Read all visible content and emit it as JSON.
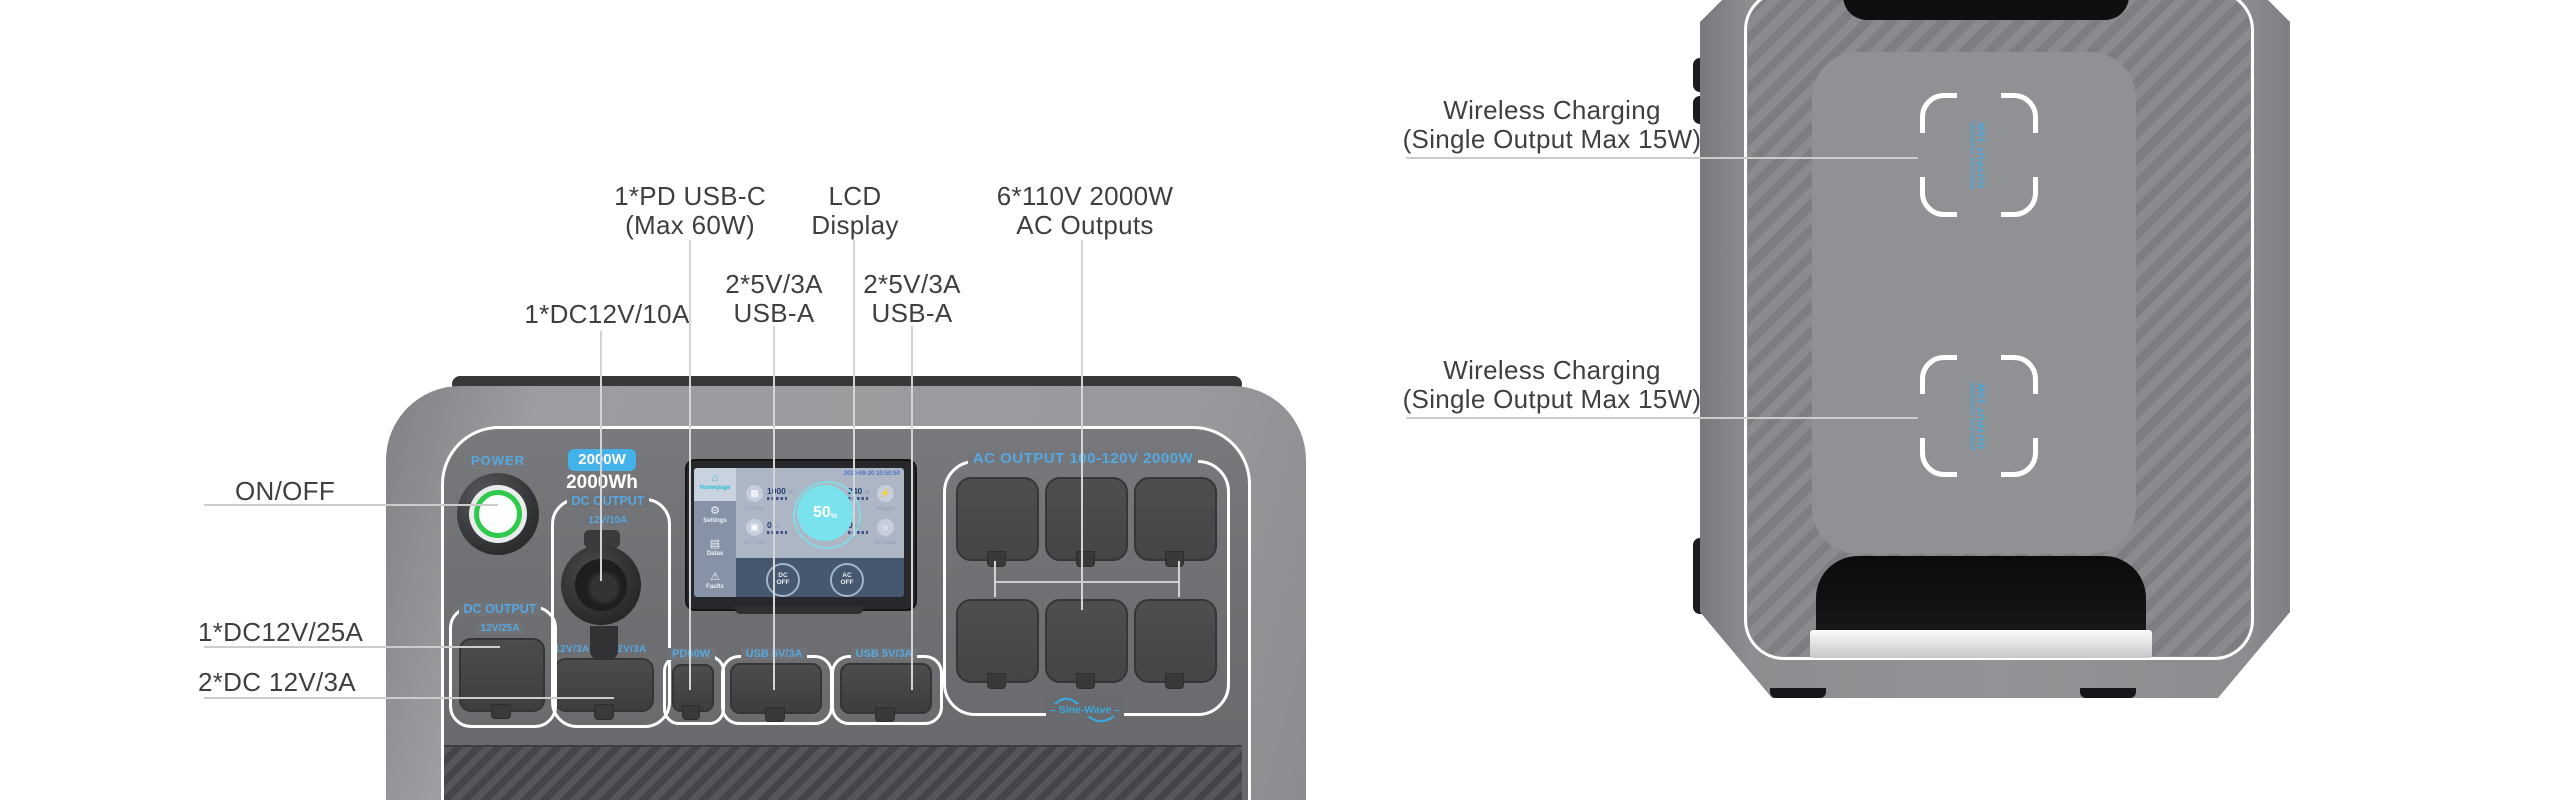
{
  "colors": {
    "accent_blue": "#57a7e0",
    "badge_blue": "#43b2ea",
    "power_green": "#2fc94b",
    "lcd_cyan": "#79e2ec",
    "callout_text": "#3f3f41",
    "callout_line": "#cbccce"
  },
  "front": {
    "callouts": {
      "on_off": "ON/OFF",
      "dc25": "1*DC12V/25A",
      "dc3": "2*DC 12V/3A",
      "dc10": "1*DC12V/10A",
      "pd_line1": "1*PD USB-C",
      "pd_line2": "(Max 60W)",
      "lcd_line1": "LCD",
      "lcd_line2": "Display",
      "usb1_line1": "2*5V/3A",
      "usb1_line2": "USB-A",
      "usb2_line1": "2*5V/3A",
      "usb2_line2": "USB-A",
      "ac_line1": "6*110V 2000W",
      "ac_line2": "AC Outputs"
    },
    "panel": {
      "power_label": "POWER",
      "rated_power": "2000W",
      "capacity": "2000Wh",
      "dc10_title": "DC OUTPUT",
      "dc10_sub": "12V/10A",
      "dc25_title": "DC OUTPUT",
      "dc25_sub": "12V/25A",
      "dc3_left": "12V/3A",
      "dc3_right": "12V/3A",
      "pd_label": "PD60W",
      "usb1_label": "USB 5V/3A",
      "usb2_label": "USB 5V/3A",
      "ac_label": "AC OUTPUT 100-120V 2000W",
      "sine_wave": "Sine-Wave"
    },
    "lcd": {
      "datetime": "2020-09-20 10:50:50",
      "menu": [
        "Homepage",
        "Settings",
        "Datas",
        "Faults"
      ],
      "icons": {
        "home": "⌂",
        "settings": "⚙",
        "datas": "▤",
        "faults": "⚠",
        "pv": "▦",
        "dc": "▣",
        "adapter": "⚡",
        "ac": "☼"
      },
      "stats": {
        "pv_value": "1000",
        "pv_unit": "W",
        "pv_label": "PV/Car",
        "dc_value": "0",
        "dc_unit": "W",
        "dc_label": "DC Load",
        "adapter_value": "240",
        "adapter_unit": "W",
        "adapter_label": "Adapter",
        "ac_value": "0",
        "ac_unit": "W",
        "ac_label": "AC Load"
      },
      "battery_percent": "50",
      "battery_unit": "%",
      "dc_button": "DC OFF",
      "ac_button": "AC OFF"
    }
  },
  "top_view": {
    "callout1_line1": "Wireless Charging",
    "callout1_line2": "(Single Output Max 15W)",
    "callout2_line1": "Wireless Charging",
    "callout2_line2": "(Single Output Max 15W)",
    "pad_text_small": "WIRELESS CHARGING",
    "pad_text_large": "OUTPUT 15W"
  }
}
